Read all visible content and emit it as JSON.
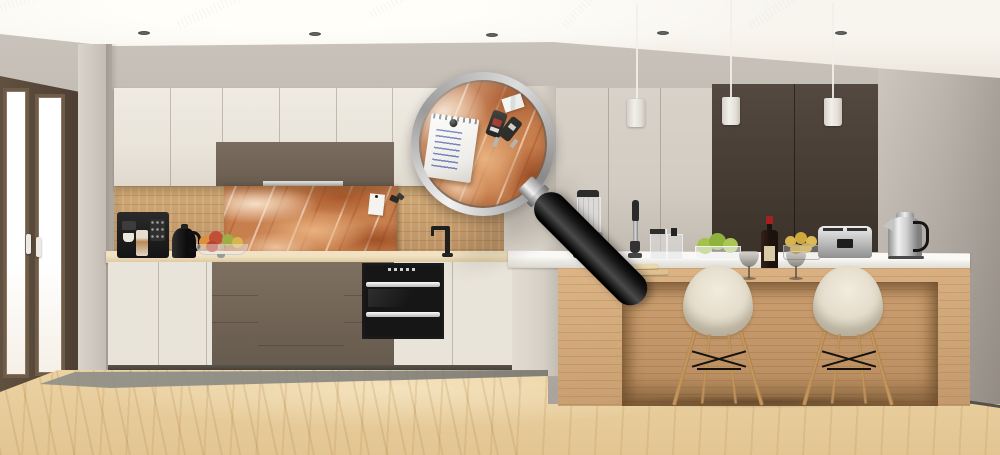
{
  "meta": {
    "kind": "photorealistic 3d render, no UI text visible",
    "description": "Modern kitchen with cream and taupe-brown cabinets, an orange marble glass splashback, a wooden island with two white shell chairs, three white pendant lights, and a large magnifying glass enlarging the marble splashback where a spiral notepad and keys are pinned"
  },
  "labels": {
    "scene": "Modern kitchen interior with magnifying glass detail of marble splashback",
    "window": "French-door window with dark wood frame",
    "ceiling": "White ceiling with linear diffusers and recessed spots",
    "upper_cabinets": "Cream upper cabinets with brown hood section",
    "splashback": "Orange-brown marble glass splashback panel",
    "lower_cabinets": "Cream and brown base cabinets",
    "oven": "Built-in black double oven",
    "coffee_machine": "Black espresso machine",
    "kettle_black": "Black kettle",
    "fruit_bowl": "Glass bowl with apples and pears",
    "faucet": "Black kitchen faucet",
    "tall_cabinets": "Tall cream pantry cabinets",
    "dark_panels": "Dark brown tall wall panels",
    "pendants": "Three white cylindrical pendant lights",
    "island": "Light wood kitchen island with white counter",
    "blender": "Jug blender",
    "hand_blender": "Stick blender",
    "jars": "Glass storage jars",
    "apple_bowl": "Bowl of green apples",
    "wine": "Red wine bottle with two glasses",
    "lemon_bowl": "Wire basket of lemons",
    "toaster": "Stainless steel toaster",
    "kettle_steel": "Stainless steel kettle",
    "chairs": "Two white shell chairs with wooden legs",
    "floor": "Light wood plank floor",
    "magnifier": "Magnifying glass with black handle",
    "notepad": "Spiral notepad pinned with magnet, handwritten list",
    "keys": "Two keys with dark fobs and tags"
  },
  "colors": {
    "ceiling": "#f8f5ef",
    "wall": "#b8b1a9",
    "frame": "#4e3f33",
    "cream": "#e9e4da",
    "brown": "#6f6254",
    "tall": "#d3ccc3",
    "panel": "#463c33",
    "wood": "#c9a06c",
    "marble": "#c87f4e",
    "counter": "#dcc69f",
    "oven": "#161616",
    "island": "#d6ad7d",
    "floor": "#ecd4a4",
    "mat": "#85857f",
    "shell": "#e4ddcc",
    "leg": "#c89a62",
    "pendant": "#f2efe9",
    "rim": "#dcdcdc",
    "handle": "#161616",
    "note": "#edece8"
  }
}
